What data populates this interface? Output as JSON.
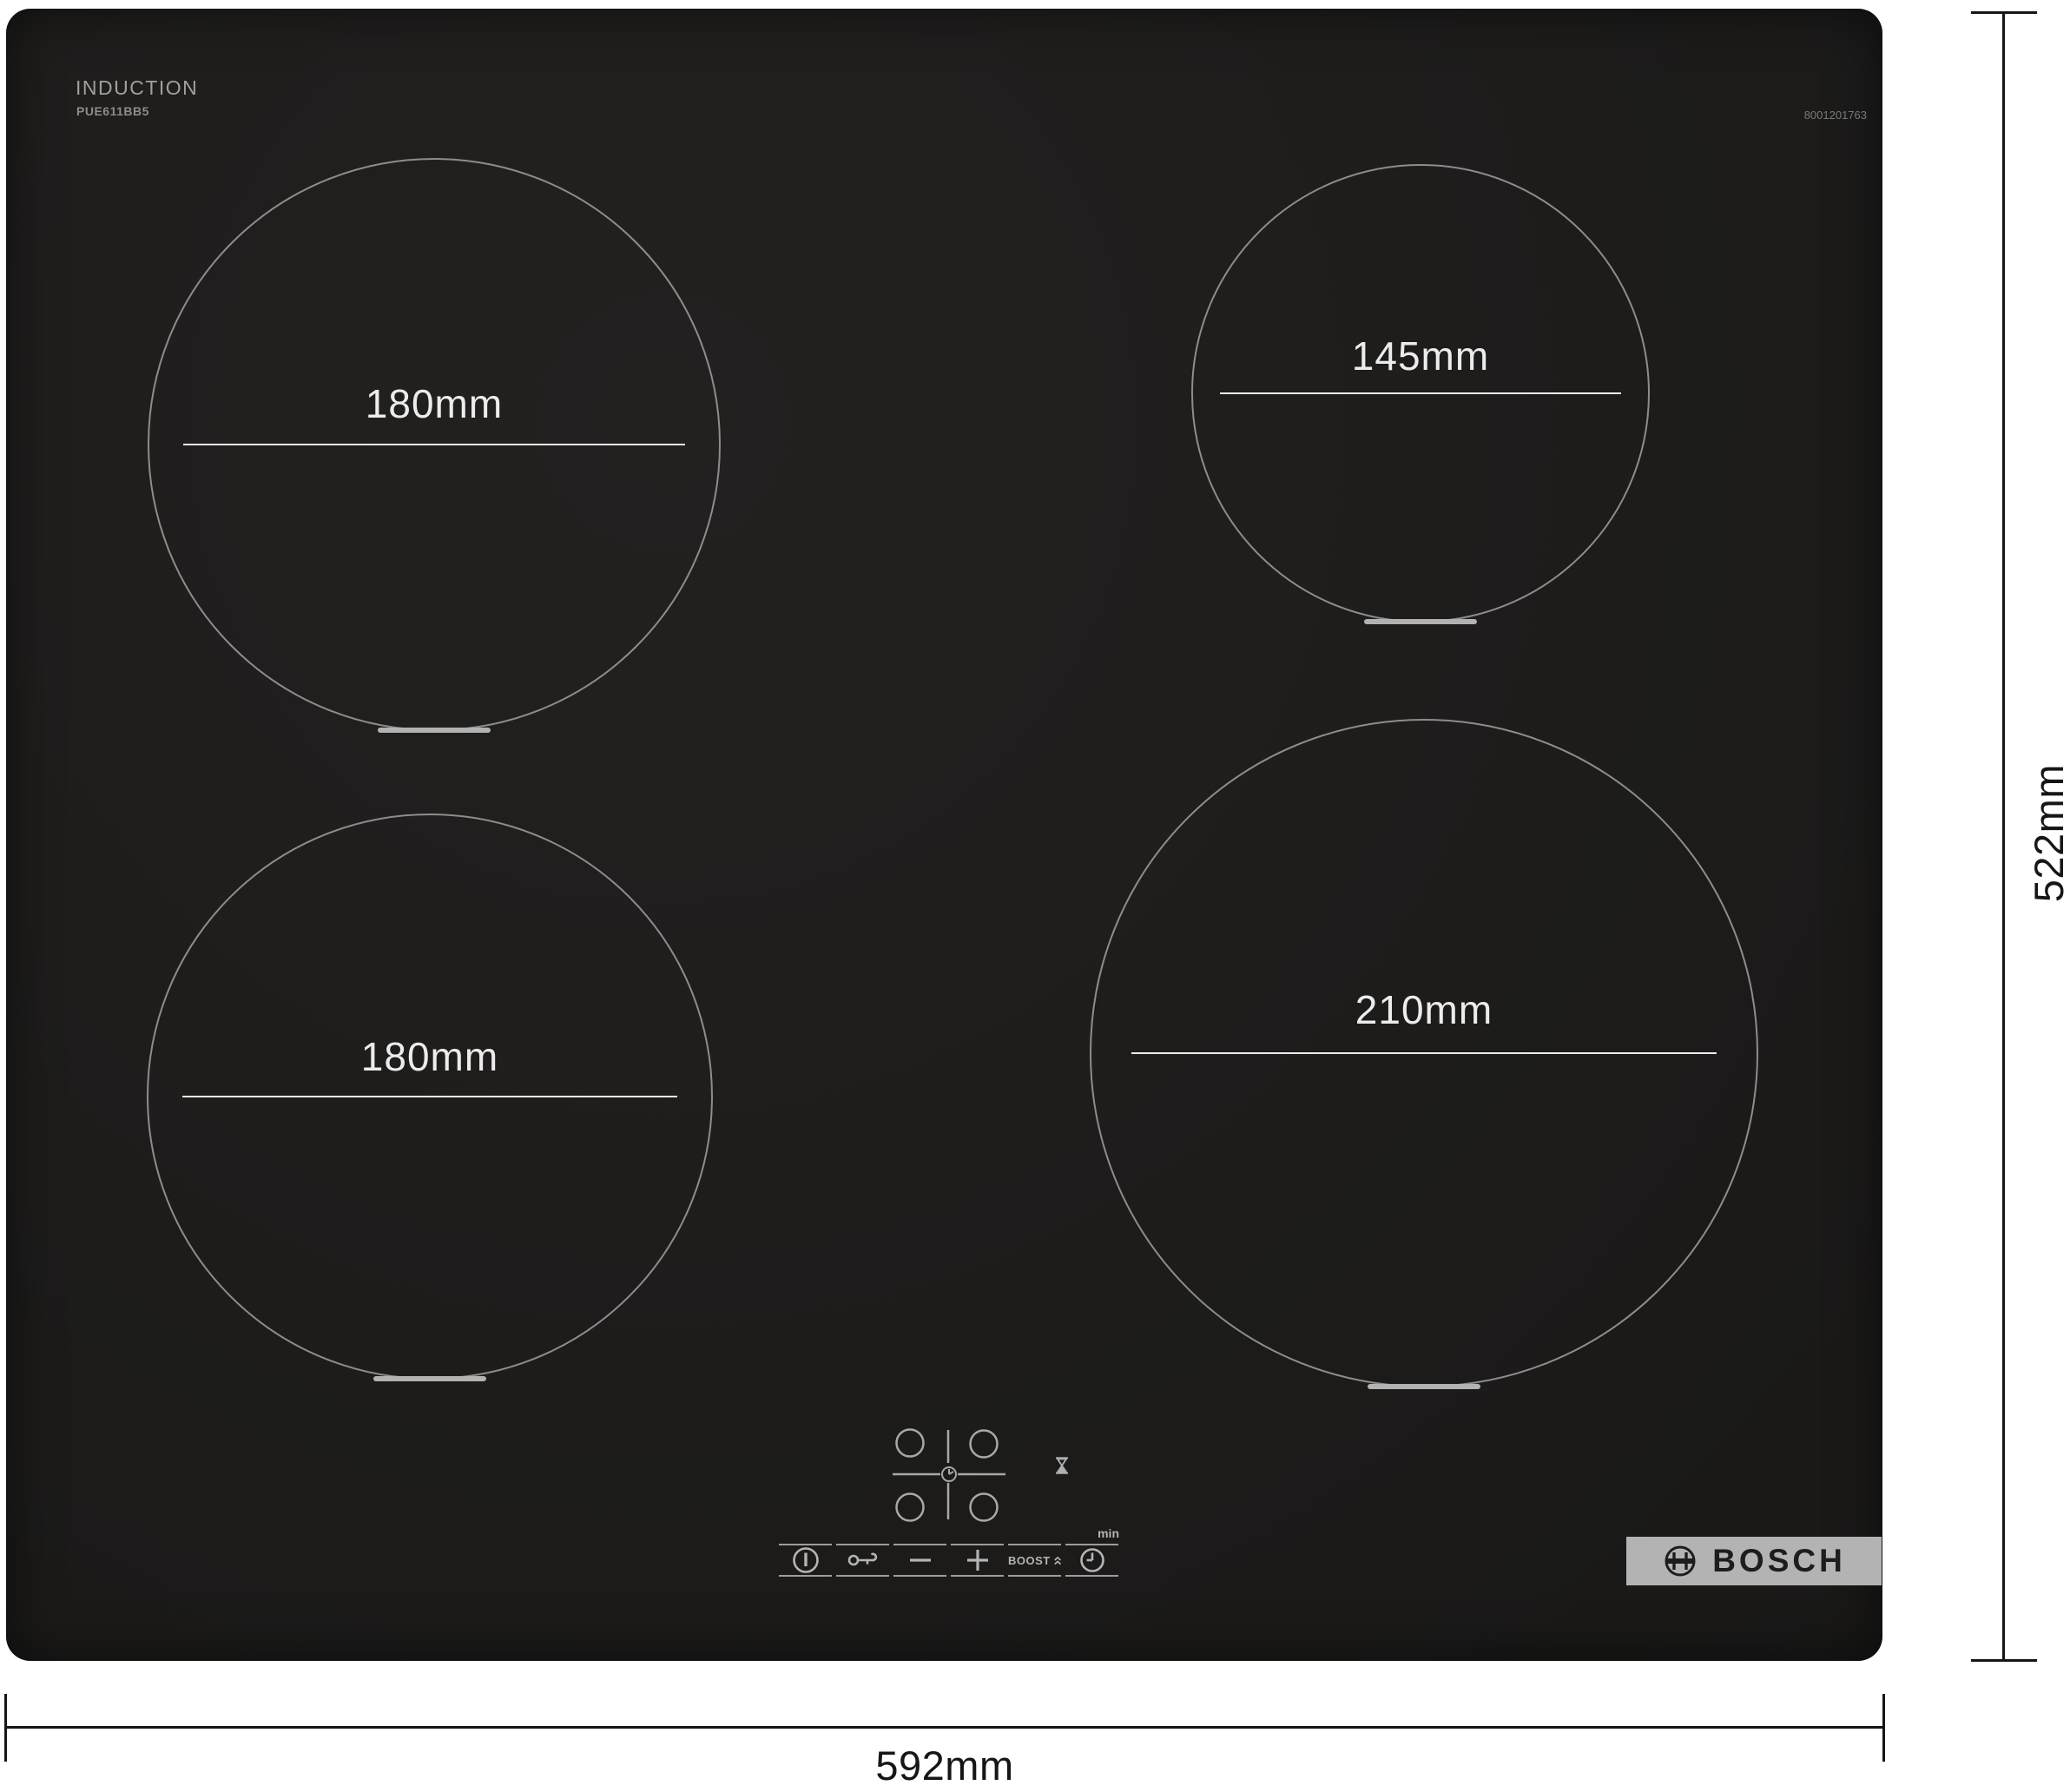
{
  "header": {
    "title": "INDUCTION",
    "model": "PUE611BB5",
    "part_number": "8001201763"
  },
  "zones": [
    {
      "position": "rear-left",
      "diameter": "180mm"
    },
    {
      "position": "rear-right",
      "diameter": "145mm"
    },
    {
      "position": "front-left",
      "diameter": "180mm"
    },
    {
      "position": "front-right",
      "diameter": "210mm"
    }
  ],
  "controls": {
    "boost_label": "BOOST",
    "timer_unit_label": "min",
    "icons": {
      "power": "standby-circle-with-bar",
      "child_lock": "key",
      "decrease": "minus",
      "increase": "plus",
      "boost": "double-chevron-up",
      "timer": "clock",
      "residual_heat": "hourglass",
      "zone_selector": "four-circles-cross-with-clock"
    }
  },
  "logo": {
    "brand": "BOSCH"
  },
  "dimensions": {
    "width": "592mm",
    "depth": "522mm"
  },
  "colors": {
    "surface": "#1d1c1b",
    "ring": "#8d8d8d",
    "marking": "#ececec",
    "dimension_ink": "#161616",
    "logo_plate": "#b3b3b3",
    "page_background": "#ffffff"
  }
}
